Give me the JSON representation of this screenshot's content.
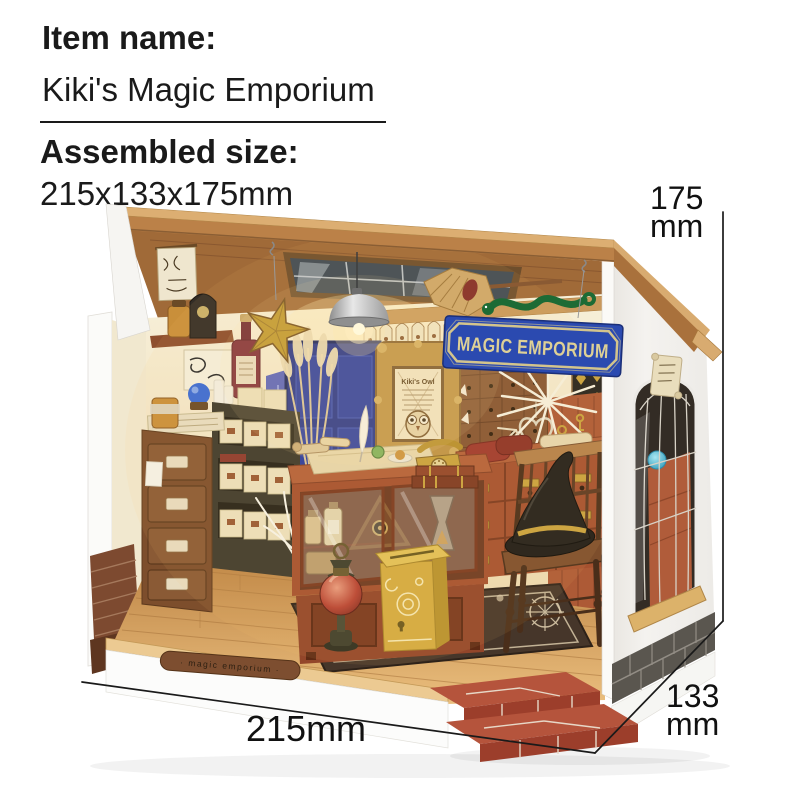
{
  "header": {
    "item_name_label": "Item name:",
    "item_name_value": "Kiki's Magic Emporium",
    "assembled_size_label": "Assembled size:",
    "assembled_size_value": "215x133x175mm"
  },
  "dimensions": {
    "height": {
      "value": "175",
      "unit": "mm"
    },
    "depth": {
      "value": "133",
      "unit": "mm"
    },
    "width": {
      "value": "215mm"
    }
  },
  "model": {
    "sign_text": "MAGIC EMPORIUM",
    "base_plaque_text": "· magic emporium ·",
    "owl_frame_title": "Kiki's Owl",
    "colors": {
      "sign_blue": "#2b4ab0",
      "sign_letters": "#ded096",
      "roof_wood": "#bb8148",
      "roof_beam": "#dcae72",
      "wall_cream": "#f3e9cd",
      "exterior_white": "#f2f0ed",
      "furniture_rust": "#a5512f",
      "floor_wood": "#d29a56",
      "brick_step_red": "#b5543c",
      "mailbox_yellow": "#d4ab41",
      "witch_hat_black": "#221f1b",
      "snake_green": "#1d6b35",
      "door_blue": "#25338a",
      "gold_accent": "#c9a23e"
    }
  }
}
